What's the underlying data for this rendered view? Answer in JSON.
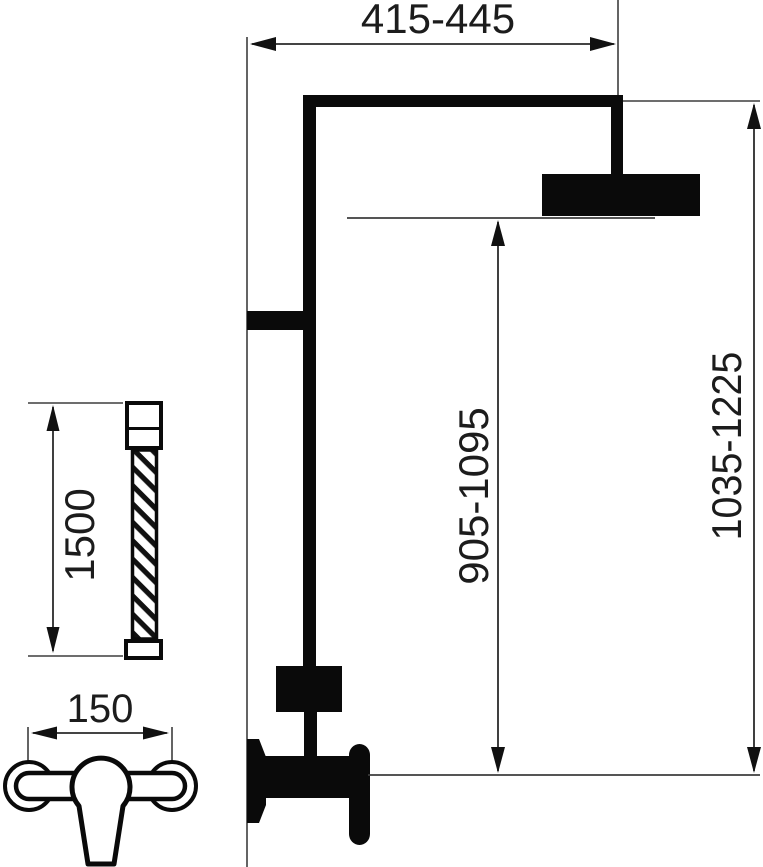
{
  "drawing": {
    "type": "technical-dimension-drawing",
    "subject": "shower column with overhead rain shower, flexible hose and wall-mounted mixer",
    "colors": {
      "ink": "#0a0a0a",
      "thin_line": "#3d3d3d",
      "text": "#1c1c1c",
      "background": "#ffffff"
    },
    "dimensions": {
      "top_width": "415-445",
      "head_to_outlet_height": "905-1095",
      "overall_height": "1035-1225",
      "hose_length": "1500",
      "mixer_center_distance": "150"
    }
  }
}
